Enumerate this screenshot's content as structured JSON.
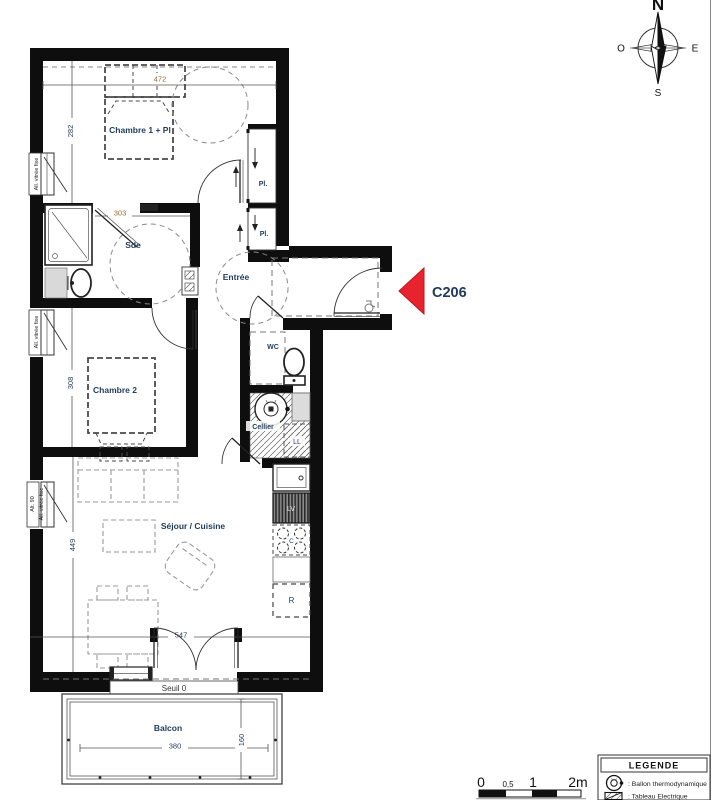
{
  "unit": {
    "code": "C206"
  },
  "colors": {
    "accent_red": "#e8232e",
    "label_navy": "#1f3a5c",
    "dim_brown": "#996b33",
    "wall_black": "#0e0e0e"
  },
  "compass": {
    "north": "N",
    "south": "S",
    "east": "E",
    "west": "O"
  },
  "rooms": {
    "chambre1": "Chambre 1 + Pl",
    "sde": "Sde",
    "entree": "Entrée",
    "placard": "Pl.",
    "wc": "WC",
    "chambre2": "Chambre 2",
    "cellier": "Cellier",
    "sejour": "Séjour / Cuisine",
    "balcon": "Balcon"
  },
  "dimensions": {
    "chambre1_width": "472",
    "chambre1_height": "282",
    "sde_width": "303",
    "chambre2_height": "308",
    "sejour_height": "449",
    "sejour_width": "547",
    "balcon_width": "380",
    "balcon_depth": "160",
    "seuil": "Seuil 0"
  },
  "appliances": {
    "washer": "LL",
    "dishwasher": "LV",
    "fridge": "R",
    "cooktop": "C"
  },
  "windows": {
    "fixed_glazing": "All. vitrée fixe",
    "sill_90": "Alt. 90"
  },
  "scalebar": {
    "t0": "0",
    "t05": "0,5",
    "t1": "1",
    "t2": "2m"
  },
  "legend": {
    "title": "LEGENDE",
    "items": [
      {
        "label": ": Ballon thermodynamique"
      },
      {
        "label": ": Tableau Electrique"
      }
    ]
  }
}
